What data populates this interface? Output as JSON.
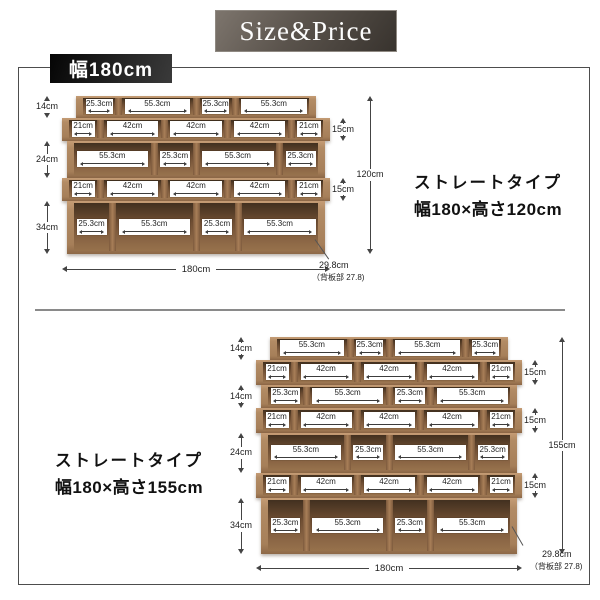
{
  "header": {
    "title": "Size&Price"
  },
  "width_banner": "幅180cm",
  "colors": {
    "header_bg": "#58514a",
    "banner_bg": "#111111",
    "wood_frame": "#ab8460",
    "wood_interior": "#6f4e33",
    "text": "#222222"
  },
  "sections": [
    {
      "id": "top",
      "type_label": "ストレートタイプ",
      "size_label": "幅180×高さ120cm",
      "total_height": "120cm",
      "total_width": "180cm",
      "depth": "29.8cm",
      "depth_note": "（背板部 27.8)",
      "rows": [
        {
          "height_cm": 14,
          "height_label": "14cm",
          "label_side": "left",
          "kind": "narrow",
          "cells": [
            "25.3cm",
            "55.3cm",
            "25.3cm",
            "55.3cm"
          ]
        },
        {
          "height_cm": 15,
          "height_label": "15cm",
          "label_side": "right",
          "kind": "offset",
          "cells": [
            "21cm",
            "42cm",
            "42cm",
            "42cm",
            "21cm"
          ]
        },
        {
          "height_cm": 24,
          "height_label": "24cm",
          "label_side": "left",
          "kind": "wide",
          "cells": [
            "55.3cm",
            "25.3cm",
            "55.3cm",
            "25.3cm"
          ]
        },
        {
          "height_cm": 15,
          "height_label": "15cm",
          "label_side": "right",
          "kind": "offset",
          "cells": [
            "21cm",
            "42cm",
            "42cm",
            "42cm",
            "21cm"
          ]
        },
        {
          "height_cm": 34,
          "height_label": "34cm",
          "label_side": "left",
          "kind": "wide",
          "cells": [
            "25.3cm",
            "55.3cm",
            "25.3cm",
            "55.3cm"
          ]
        }
      ]
    },
    {
      "id": "bottom",
      "type_label": "ストレートタイプ",
      "size_label": "幅180×高さ155cm",
      "total_height": "155cm",
      "total_width": "180cm",
      "depth": "29.8cm",
      "depth_note": "（背板部 27.8)",
      "rows": [
        {
          "height_cm": 14,
          "height_label": "14cm",
          "label_side": "left",
          "kind": "narrow",
          "cells": [
            "55.3cm",
            "25.3cm",
            "55.3cm",
            "25.3cm"
          ]
        },
        {
          "height_cm": 15,
          "height_label": "15cm",
          "label_side": "right",
          "kind": "offset",
          "cells": [
            "21cm",
            "42cm",
            "42cm",
            "42cm",
            "21cm"
          ]
        },
        {
          "height_cm": 14,
          "height_label": "14cm",
          "label_side": "left",
          "kind": "wide",
          "cells": [
            "25.3cm",
            "55.3cm",
            "25.3cm",
            "55.3cm"
          ]
        },
        {
          "height_cm": 15,
          "height_label": "15cm",
          "label_side": "right",
          "kind": "offset",
          "cells": [
            "21cm",
            "42cm",
            "42cm",
            "42cm",
            "21cm"
          ]
        },
        {
          "height_cm": 24,
          "height_label": "24cm",
          "label_side": "left",
          "kind": "wide",
          "cells": [
            "55.3cm",
            "25.3cm",
            "55.3cm",
            "25.3cm"
          ]
        },
        {
          "height_cm": 15,
          "height_label": "15cm",
          "label_side": "right",
          "kind": "offset",
          "cells": [
            "21cm",
            "42cm",
            "42cm",
            "42cm",
            "21cm"
          ]
        },
        {
          "height_cm": 34,
          "height_label": "34cm",
          "label_side": "left",
          "kind": "wide",
          "cells": [
            "25.3cm",
            "55.3cm",
            "25.3cm",
            "55.3cm"
          ]
        }
      ]
    }
  ]
}
